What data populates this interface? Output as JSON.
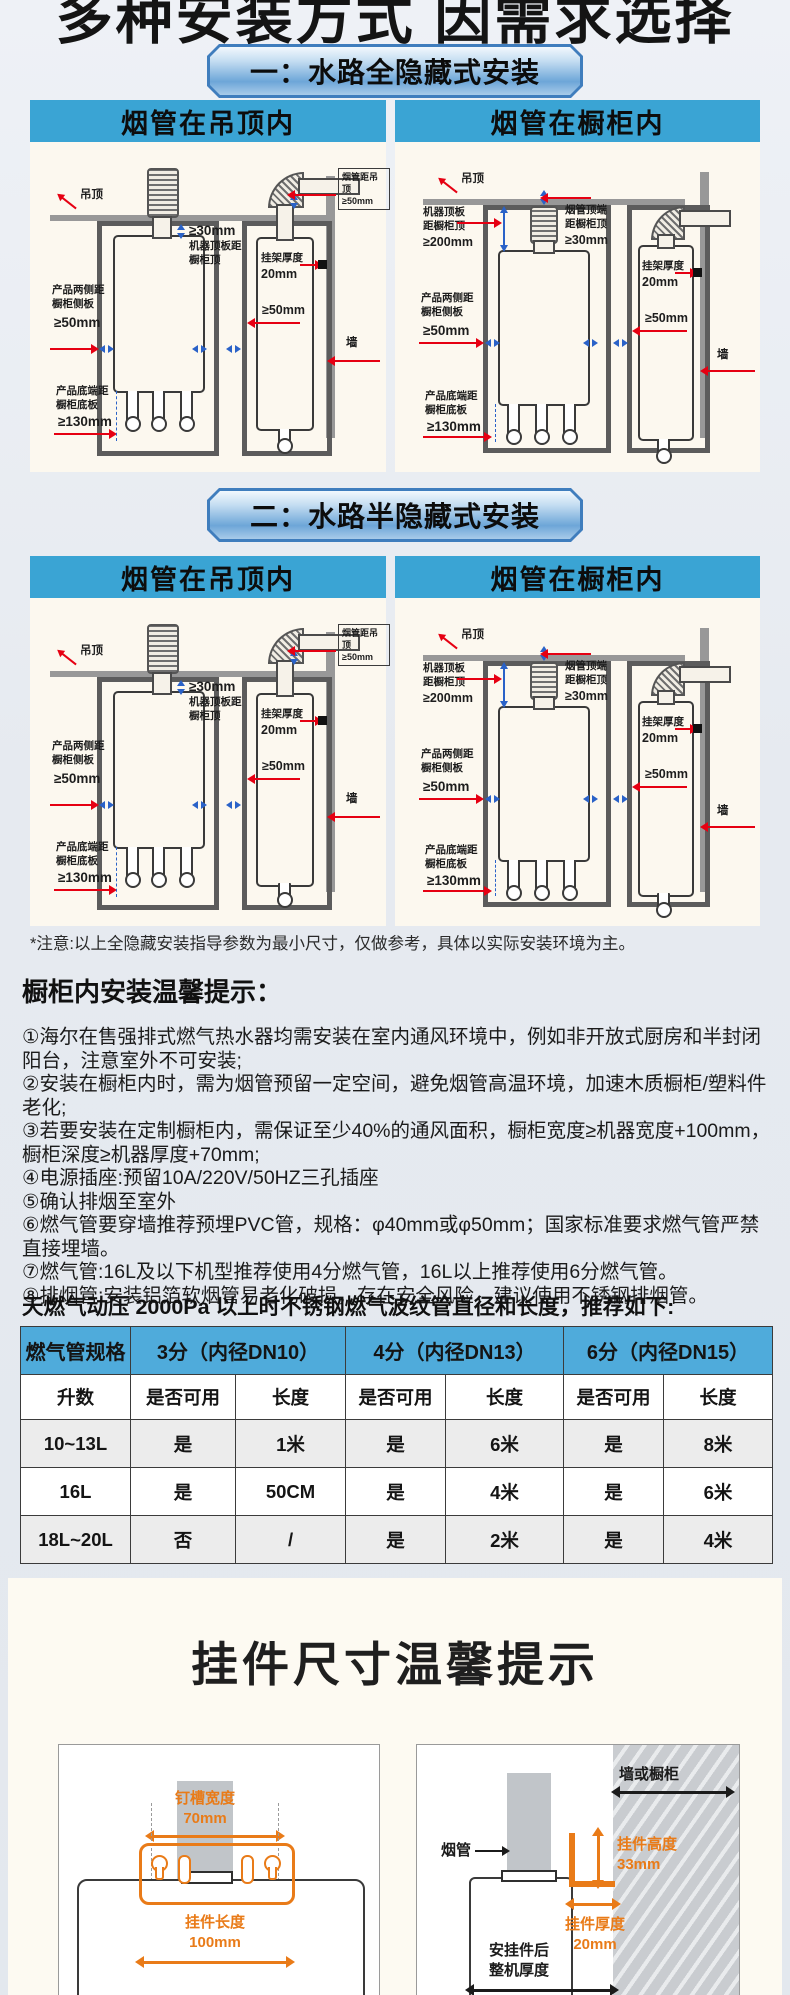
{
  "title": "多种安装方式 因需求选择",
  "banners": {
    "s1": "一：水路全隐藏式安装",
    "s2": "二：水路半隐藏式安装"
  },
  "panel_headers": {
    "ceiling": "烟管在吊顶内",
    "cabinet": "烟管在橱柜内"
  },
  "diagram_labels": {
    "ceiling": "吊顶",
    "wall": "墙",
    "flue_to_ceiling": "烟管距吊顶",
    "flue_to_ceiling_val": "≥50mm",
    "ge30": "≥30mm",
    "machine_top_gap": "机器顶板距橱柜顶",
    "machine_top_gap_val": "≥200mm",
    "flue_top_gap": "烟管顶端距橱柜顶",
    "flue_top_gap_val": "≥30mm",
    "bracket_thickness": "挂架厚度",
    "bracket_thickness_val": "20mm",
    "side_gap": "产品两侧距橱柜侧板",
    "side_gap_val": "≥50mm",
    "ge50": "≥50mm",
    "bottom_gap": "产品底端距橱柜底板",
    "bottom_gap_val": "≥130mm"
  },
  "note": "*注意:以上全隐藏安装指导参数为最小尺寸，仅做参考，具体以实际安装环境为主。",
  "tips": {
    "heading": "橱柜内安装温馨提示：",
    "items": [
      "①海尔在售强排式燃气热水器均需安装在室内通风环境中，例如非开放式厨房和半封闭阳台，注意室外不可安装;",
      "②安装在橱柜内时，需为烟管预留一定空间，避免烟管高温环境，加速木质橱柜/塑料件老化;",
      "③若要安装在定制橱柜内，需保证至少40%的通风面积，橱柜宽度≥机器宽度+100mm，橱柜深度≥机器厚度+70mm;",
      "④电源插座:预留10A/220V/50HZ三孔插座",
      "⑤确认排烟至室外",
      "⑥燃气管要穿墙推荐预埋PVC管，规格：φ40mm或φ50mm；国家标准要求燃气管严禁直接埋墙。",
      "⑦燃气管:16L及以下机型推荐使用4分燃气管，16L以上推荐使用6分燃气管。",
      "⑧排烟管:安装铝箔软烟管易老化破损，存在安全风险，建议使用不锈钢排烟管。"
    ]
  },
  "gas_table": {
    "intro": "天燃气动压 2000Pa 以上时不锈钢燃气波纹管直径和长度，推荐如下:",
    "col_headers": [
      "燃气管规格",
      "3分（内径DN10）",
      "4分（内径DN13）",
      "6分（内径DN15）"
    ],
    "sub_headers": [
      "升数",
      "是否可用",
      "长度",
      "是否可用",
      "长度",
      "是否可用",
      "长度"
    ],
    "rows": [
      [
        "10~13L",
        "是",
        "1米",
        "是",
        "6米",
        "是",
        "8米"
      ],
      [
        "16L",
        "是",
        "50CM",
        "是",
        "4米",
        "是",
        "6米"
      ],
      [
        "18L~20L",
        "否",
        "/",
        "是",
        "2米",
        "是",
        "4米"
      ]
    ]
  },
  "bracket_card": {
    "title": "挂件尺寸温馨提示",
    "slot_width": "钉槽宽度",
    "slot_width_val": "70mm",
    "bracket_length": "挂件长度",
    "bracket_length_val": "100mm",
    "wall_or_cabinet": "墙或橱柜",
    "flue": "烟管",
    "bracket_height": "挂件高度",
    "bracket_height_val": "33mm",
    "bracket_depth": "挂件厚度",
    "bracket_depth_val": "20mm",
    "machine_depth": "安挂件后整机厚度"
  },
  "colors": {
    "panel_header_blue": "#3aa4d4",
    "table_header_blue": "#4fabdb",
    "dimension_red": "#e60012",
    "dimension_blue": "#2a62c8",
    "dimension_orange": "#e97b18",
    "panel_cream": "#fcf8ef",
    "card_cream": "#fdfaf2"
  }
}
